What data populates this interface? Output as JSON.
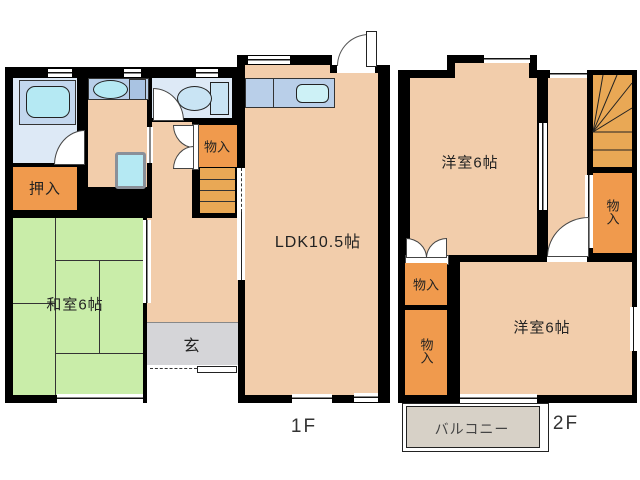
{
  "plan_title": "2-story house floor plan",
  "colors": {
    "wall": "#000000",
    "floor": "#f2cdab",
    "tatami": "#c9eda9",
    "closet": "#f09a4d",
    "stairs": "#e9a855",
    "water": "#dde9f6",
    "counter": "#b9cfe9",
    "fixture": "#b5e9f3",
    "genkan": "#d5d5d8",
    "balcony": "#d7d1c7"
  },
  "f1": {
    "label": "1F",
    "ldk": "LDK10.5帖",
    "washitsu": "和室6帖",
    "oshiire": "押入",
    "monoire": "物入",
    "genkan": "玄"
  },
  "f2": {
    "label": "2F",
    "yo1": "洋室6帖",
    "yo2": "洋室6帖",
    "mono_right": "物入",
    "mono_mid": "物入",
    "mono_low": "物入",
    "balcony": "バルコニー"
  }
}
